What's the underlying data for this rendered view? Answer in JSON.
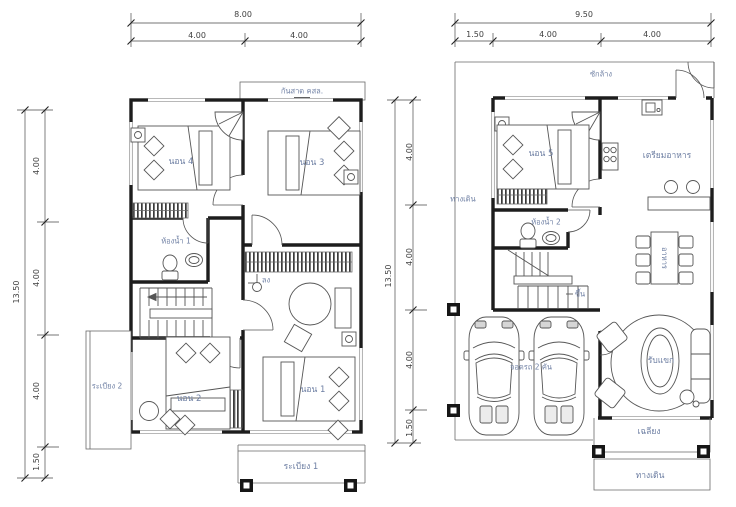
{
  "colors": {
    "background": "#ffffff",
    "wall": "#1d1d1d",
    "label": "#6e7fa3",
    "dim": "#3f3f3f"
  },
  "left_plan": {
    "dims_top": {
      "total": "8.00",
      "segments": [
        "4.00",
        "4.00"
      ]
    },
    "dims_left": {
      "total": "13.50",
      "segments": [
        "4.00",
        "4.00",
        "4.00",
        "1.50"
      ]
    },
    "labels": {
      "canopy": "กันสาด คสล.",
      "bedroom4": "นอน 4",
      "bedroom3": "นอน 3",
      "bath1": "ห้องน้ำ 1",
      "down": "ลง",
      "balcony2": "ระเบียง 2",
      "bedroom2": "นอน 2",
      "bedroom1": "นอน 1",
      "balcony1": "ระเบียง 1"
    }
  },
  "right_plan": {
    "dims_top": {
      "total": "9.50",
      "segments": [
        "1.50",
        "4.00",
        "4.00"
      ]
    },
    "dims_left": {
      "total": "13.50",
      "segments": [
        "4.00",
        "4.00",
        "4.00",
        "1.50"
      ]
    },
    "labels": {
      "laundry": "ซักล้าง",
      "bedroom5": "นอน 5",
      "kitchen": "เตรียมอาหาร",
      "walkway_left": "ทางเดิน",
      "bath2": "ห้องน้ำ 2",
      "up": "ขึ้น",
      "dining": "อาหาร",
      "carport": "จอดรถ 2 คัน",
      "living": "รับแขก",
      "porch": "เฉลียง",
      "walkway_bottom": "ทางเดิน"
    }
  }
}
